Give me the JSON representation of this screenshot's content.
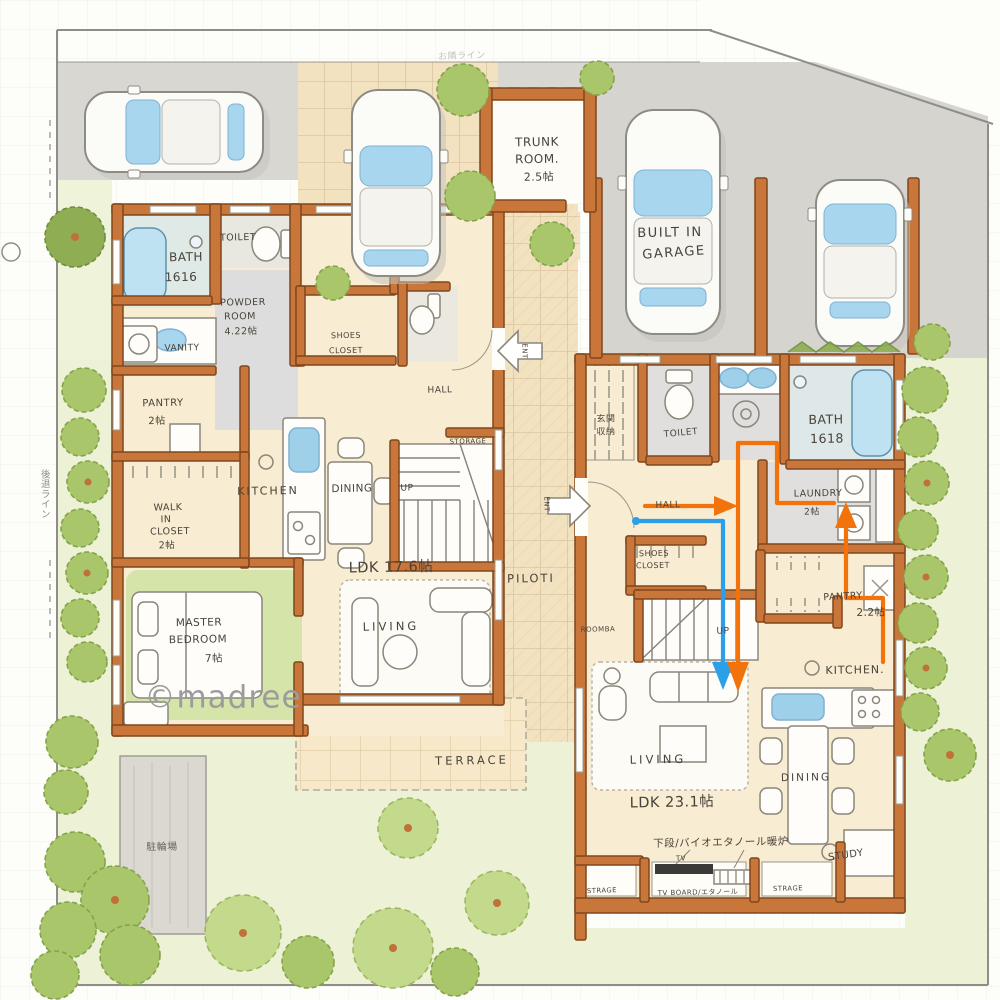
{
  "colors": {
    "wall": "#c9763a",
    "flow_blue": "#2b9fe8",
    "flow_orange": "#f2720c",
    "water": "#a9d6ef",
    "greenery": "#a9c76a"
  },
  "annotations": {
    "watermark": "©madree",
    "setback_line": "後退ライン",
    "neighbor_line": "お隣ライン",
    "bicycle_area": "駐輪場"
  },
  "outdoor": {
    "trunk_room": {
      "l1": "TRUNK",
      "l2": "ROOM.",
      "size": "2.5帖"
    },
    "garage": {
      "l1": "BUILT IN",
      "l2": "GARAGE"
    }
  },
  "shared": {
    "piloti": "PILOTI",
    "terrace": "TERRACE"
  },
  "left_house": {
    "bath": {
      "name": "BATH",
      "size": "1616"
    },
    "toilet": "TOILET",
    "powder_room": {
      "l1": "POWDER",
      "l2": "ROOM",
      "size": "4.22帖"
    },
    "vanity": "VANITY",
    "pantry": {
      "name": "PANTRY",
      "size": "2帖"
    },
    "kitchen": "KITCHEN",
    "dining": "DINING",
    "walk_in_closet": {
      "l1": "WALK",
      "l2": "IN",
      "l3": "CLOSET",
      "size": "2帖"
    },
    "ldk": "LDK 17.6帖",
    "master_bedroom": {
      "l1": "MASTER",
      "l2": "BEDROOM",
      "size": "7帖"
    },
    "living": "LIVING",
    "hall": "HALL",
    "storage": "STORAGE",
    "up": "UP",
    "shoes_closet": {
      "l1": "SHOES",
      "l2": "CLOSET"
    },
    "entrance": "ENT"
  },
  "right_house": {
    "entrance_storage": {
      "l1": "玄関",
      "l2": "収納"
    },
    "toilet": "TOILET",
    "bath": {
      "name": "BATH",
      "size": "1618"
    },
    "laundry": {
      "name": "LAUNDRY",
      "size": "2帖"
    },
    "hall": "HALL",
    "shoes_closet": {
      "l1": "SHOES",
      "l2": "CLOSET"
    },
    "roomba": "ROOMBA",
    "up": "UP",
    "pantry": {
      "name": "PANTRY",
      "size": "2.2帖"
    },
    "kitchen": "KITCHEN.",
    "dining": "DINING",
    "living": "LIVING",
    "ldk": "LDK 23.1帖",
    "fireplace_note": "下段/バイオエタノール暖炉",
    "tv": "TV",
    "storage_left": "STRAGE",
    "tv_board": "TV BOARD/エタノール",
    "storage_right": "STRAGE",
    "study": "STUDY",
    "entrance": "ENT"
  }
}
